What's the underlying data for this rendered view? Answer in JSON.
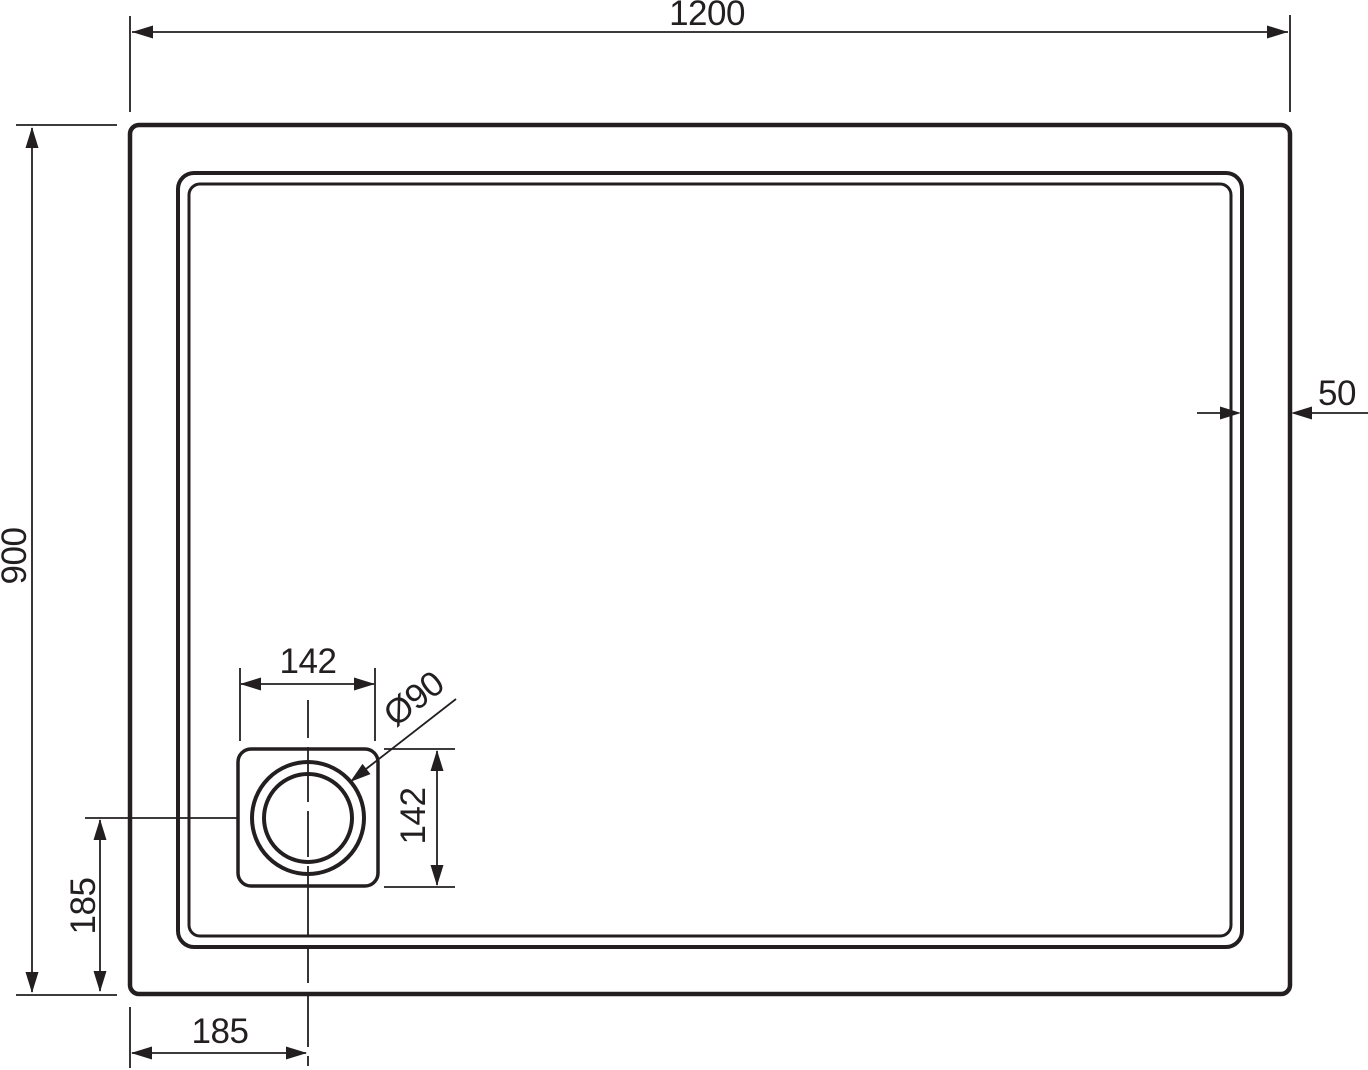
{
  "labels": {
    "overall_width": "1200",
    "overall_depth": "900",
    "rim_width": "50",
    "drain_box_width": "142",
    "drain_box_height": "142",
    "drain_diameter": "Ø90",
    "drain_center_from_left_edge": "185",
    "drain_center_to_bottom_edge": "185"
  },
  "colors": {
    "line": "#231f20",
    "background": "#ffffff"
  }
}
